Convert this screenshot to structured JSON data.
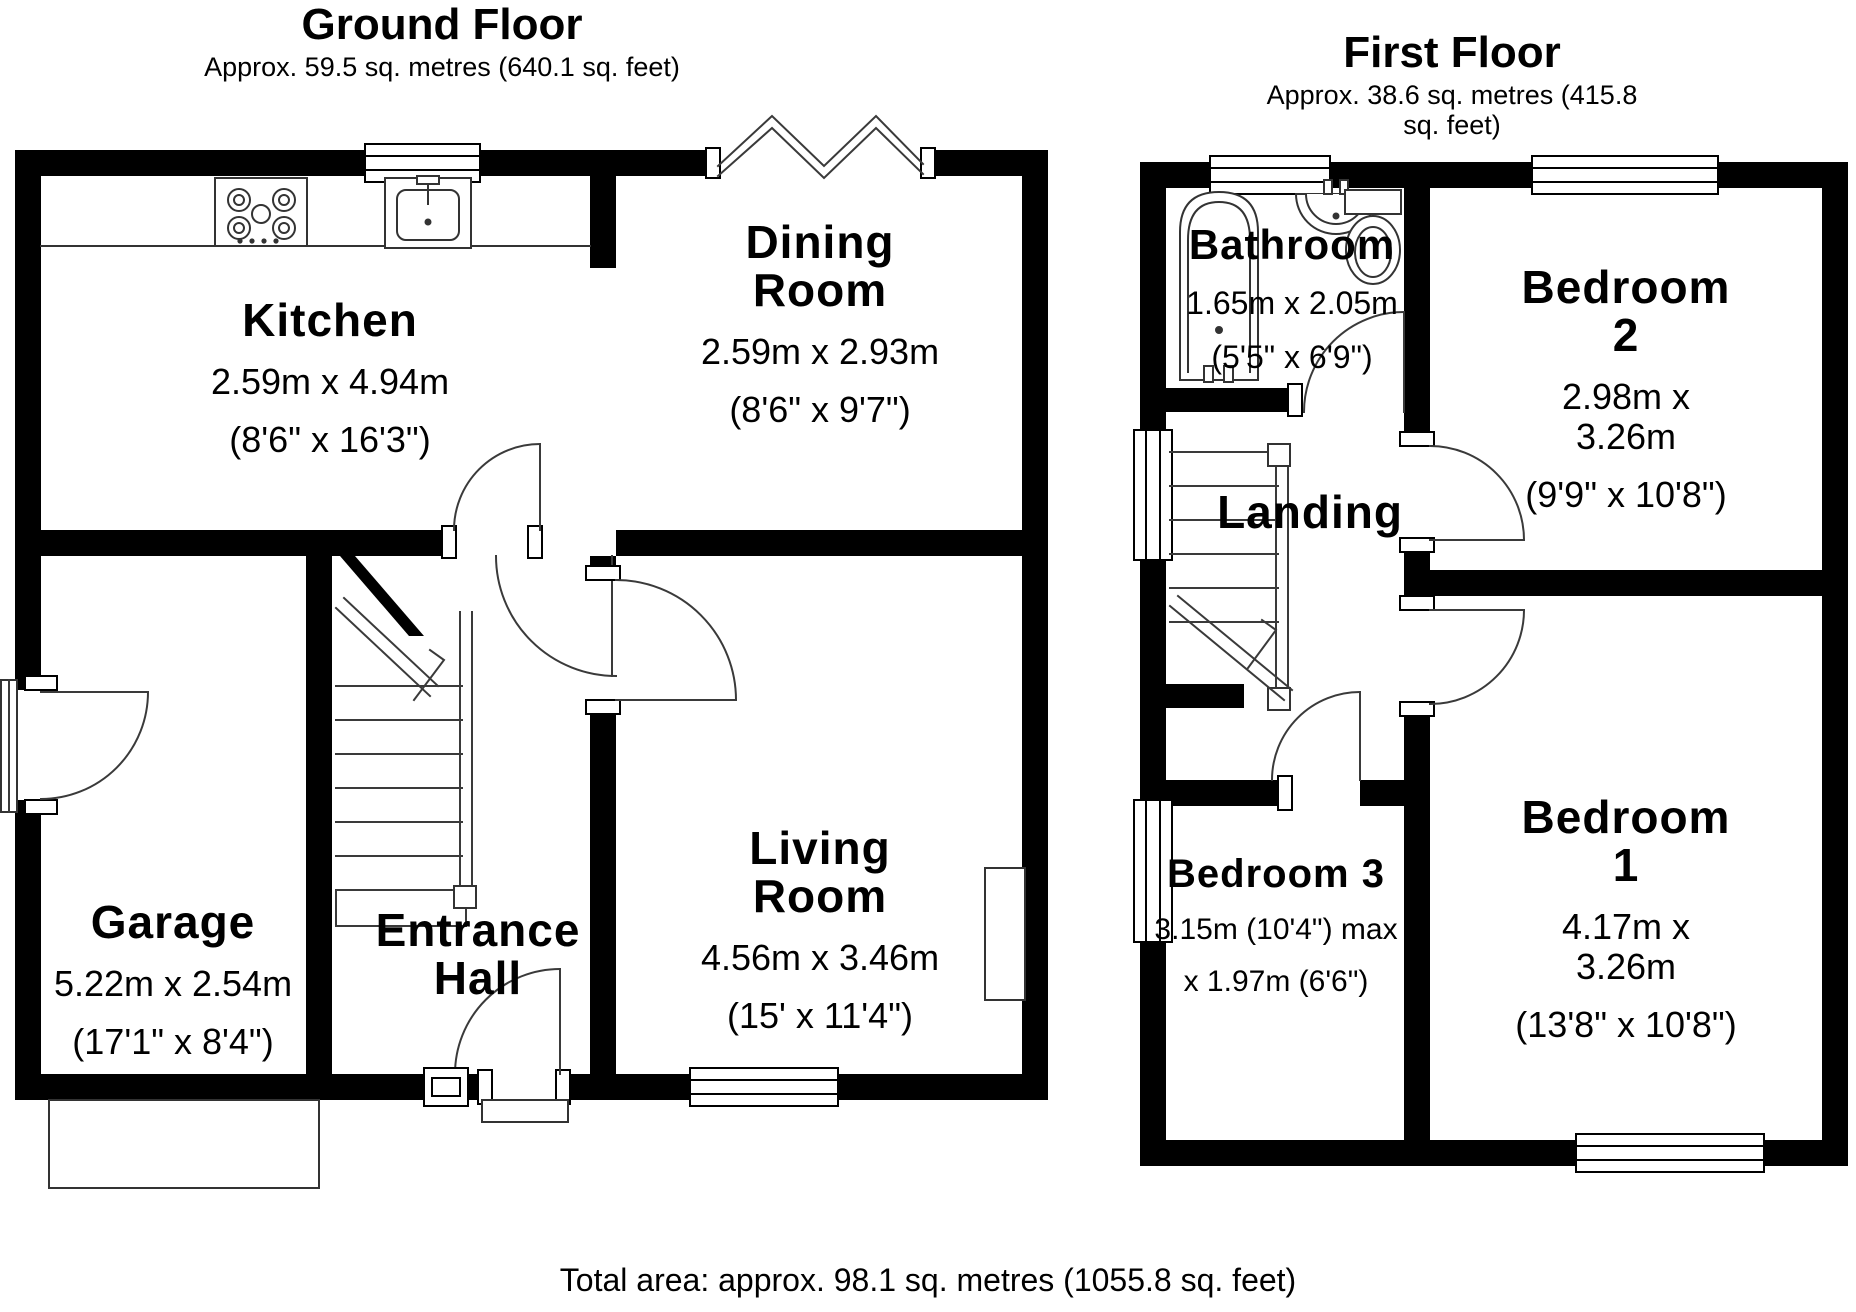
{
  "ground_floor": {
    "title": "Ground Floor",
    "subtitle": "Approx. 59.5 sq. metres (640.1 sq. feet)",
    "rooms": {
      "kitchen": {
        "name": "Kitchen",
        "metric": "2.59m x 4.94m",
        "imperial": "(8'6\" x 16'3\")"
      },
      "dining": {
        "name": "Dining\nRoom",
        "metric": "2.59m x 2.93m",
        "imperial": "(8'6\" x 9'7\")"
      },
      "garage": {
        "name": "Garage",
        "metric": "5.22m x 2.54m",
        "imperial": "(17'1\" x 8'4\")"
      },
      "living": {
        "name": "Living\nRoom",
        "metric": "4.56m x 3.46m",
        "imperial": "(15' x 11'4\")"
      },
      "hall": {
        "name": "Entrance\nHall"
      }
    }
  },
  "first_floor": {
    "title": "First Floor",
    "subtitle": "Approx. 38.6 sq. metres (415.8 sq. feet)",
    "rooms": {
      "bathroom": {
        "name": "Bathroom",
        "metric": "1.65m x 2.05m",
        "imperial": "(5'5\" x 6'9\")"
      },
      "bedroom2": {
        "name": "Bedroom 2",
        "metric": "2.98m x 3.26m",
        "imperial": "(9'9\" x 10'8\")"
      },
      "landing": {
        "name": "Landing"
      },
      "bedroom3": {
        "name": "Bedroom 3",
        "metric": "3.15m (10'4\") max",
        "imperial": "x 1.97m (6'6\")"
      },
      "bedroom1": {
        "name": "Bedroom 1",
        "metric": "4.17m x 3.26m",
        "imperial": "(13'8\" x 10'8\")"
      }
    }
  },
  "footer": {
    "total_area": "Total area: approx. 98.1 sq. metres (1055.8 sq. feet)"
  },
  "colors": {
    "wall": "#000000",
    "background": "#ffffff",
    "line": "#3a3a3a"
  }
}
